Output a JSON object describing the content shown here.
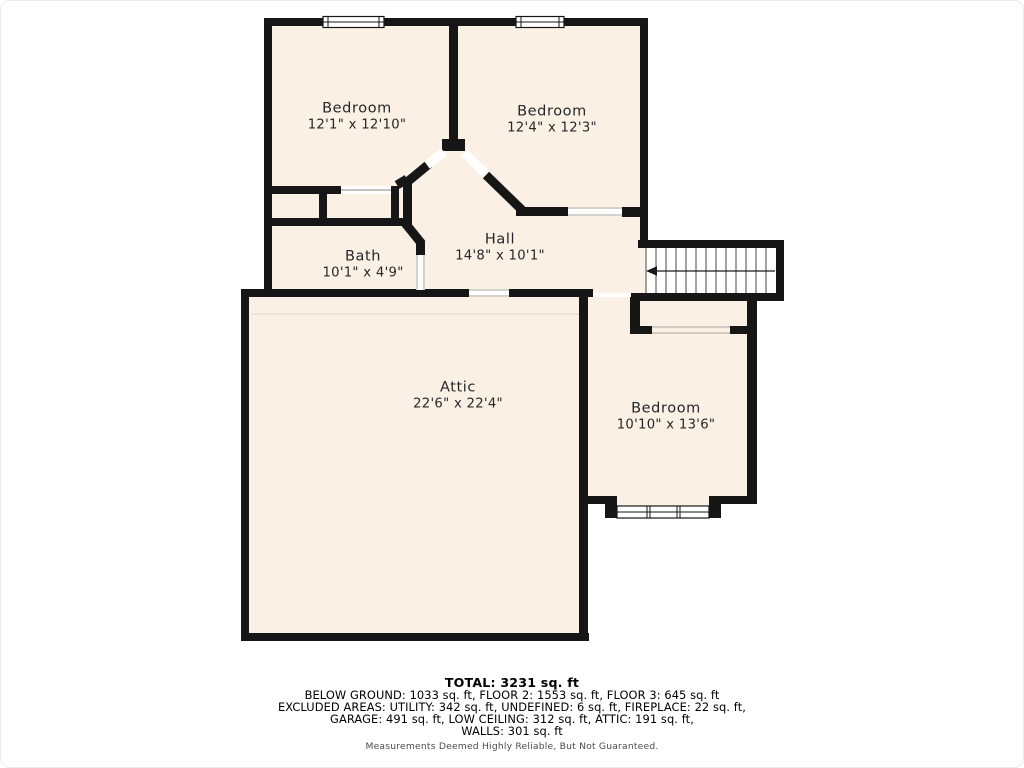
{
  "rooms": [
    {
      "name": "Bedroom",
      "dims": "12'1\" x 12'10\""
    },
    {
      "name": "Bedroom",
      "dims": "12'4\" x 12'3\""
    },
    {
      "name": "Bath",
      "dims": "10'1\" x 4'9\""
    },
    {
      "name": "Hall",
      "dims": "14'8\" x 10'1\""
    },
    {
      "name": "Attic",
      "dims": "22'6\" x 22'4\""
    },
    {
      "name": "Bedroom",
      "dims": "10'10\" x 13'6\""
    }
  ],
  "summary": {
    "total": "TOTAL: 3231 sq. ft",
    "line1": "BELOW GROUND: 1033 sq. ft, FLOOR 2: 1553 sq. ft, FLOOR 3: 645 sq. ft",
    "line2": "EXCLUDED AREAS: UTILITY: 342 sq. ft, UNDEFINED: 6 sq. ft, FIREPLACE: 22 sq. ft,",
    "line3": "GARAGE: 491 sq. ft, LOW CEILING: 312 sq. ft, ATTIC: 191 sq. ft,",
    "line4": "WALLS: 301 sq. ft",
    "disclaimer": "Measurements Deemed Highly Reliable, But Not Guaranteed."
  },
  "stairs": {
    "direction": "left",
    "treads": 13
  },
  "colors": {
    "floor": "#faf1e4",
    "wall": "#161616",
    "background": "#ffffff"
  }
}
